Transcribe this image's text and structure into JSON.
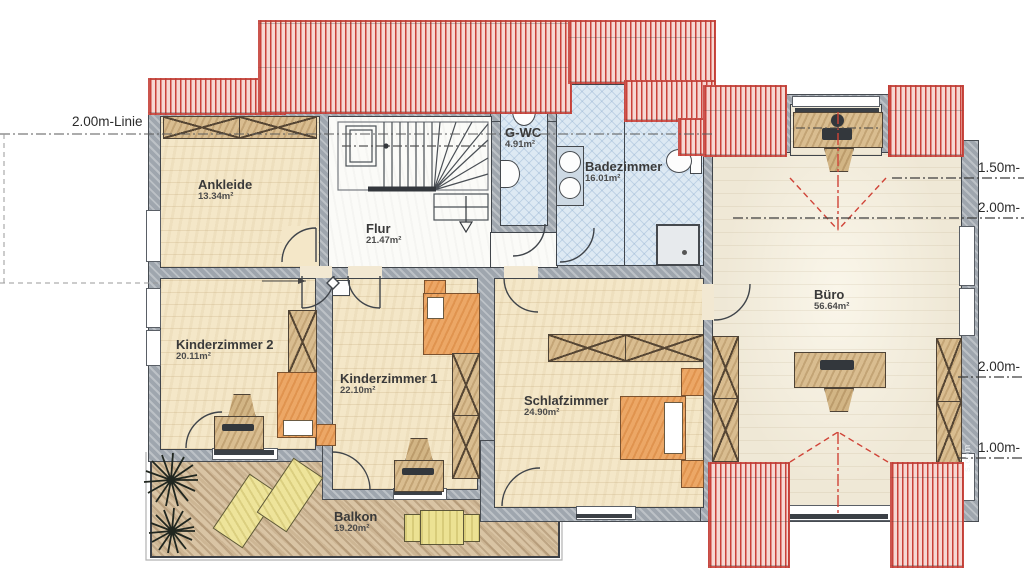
{
  "plan_title": "Obergeschoss Grundriss",
  "rooms": [
    {
      "id": "ankleide",
      "name": "Ankleide",
      "area": "13.34m²"
    },
    {
      "id": "flur",
      "name": "Flur",
      "area": "21.47m²"
    },
    {
      "id": "gwc",
      "name": "G-WC",
      "area": "4.91m²"
    },
    {
      "id": "badezimmer",
      "name": "Badezimmer",
      "area": "16.01m²"
    },
    {
      "id": "kinderzimmer2",
      "name": "Kinderzimmer 2",
      "area": "20.11m²"
    },
    {
      "id": "kinderzimmer1",
      "name": "Kinderzimmer 1",
      "area": "22.10m²"
    },
    {
      "id": "schlafzimmer",
      "name": "Schlafzimmer",
      "area": "24.90m²"
    },
    {
      "id": "buero",
      "name": "Büro",
      "area": "56.64m²"
    },
    {
      "id": "balkon",
      "name": "Balkon",
      "area": "19.20m²"
    }
  ],
  "dimensions": {
    "left_line_label": "2.00m-Linie",
    "right_labels": [
      "1.50m-",
      "2.00m-",
      "2.00m-",
      "1.00m-"
    ]
  },
  "watermark": "s.com",
  "colors": {
    "roof": "#c9423a",
    "wall": "#9fa6ae",
    "floor": "#f4e7c8",
    "bath": "#dde9f3",
    "balcony": "#d9c4a4",
    "sight": "#d04438"
  }
}
